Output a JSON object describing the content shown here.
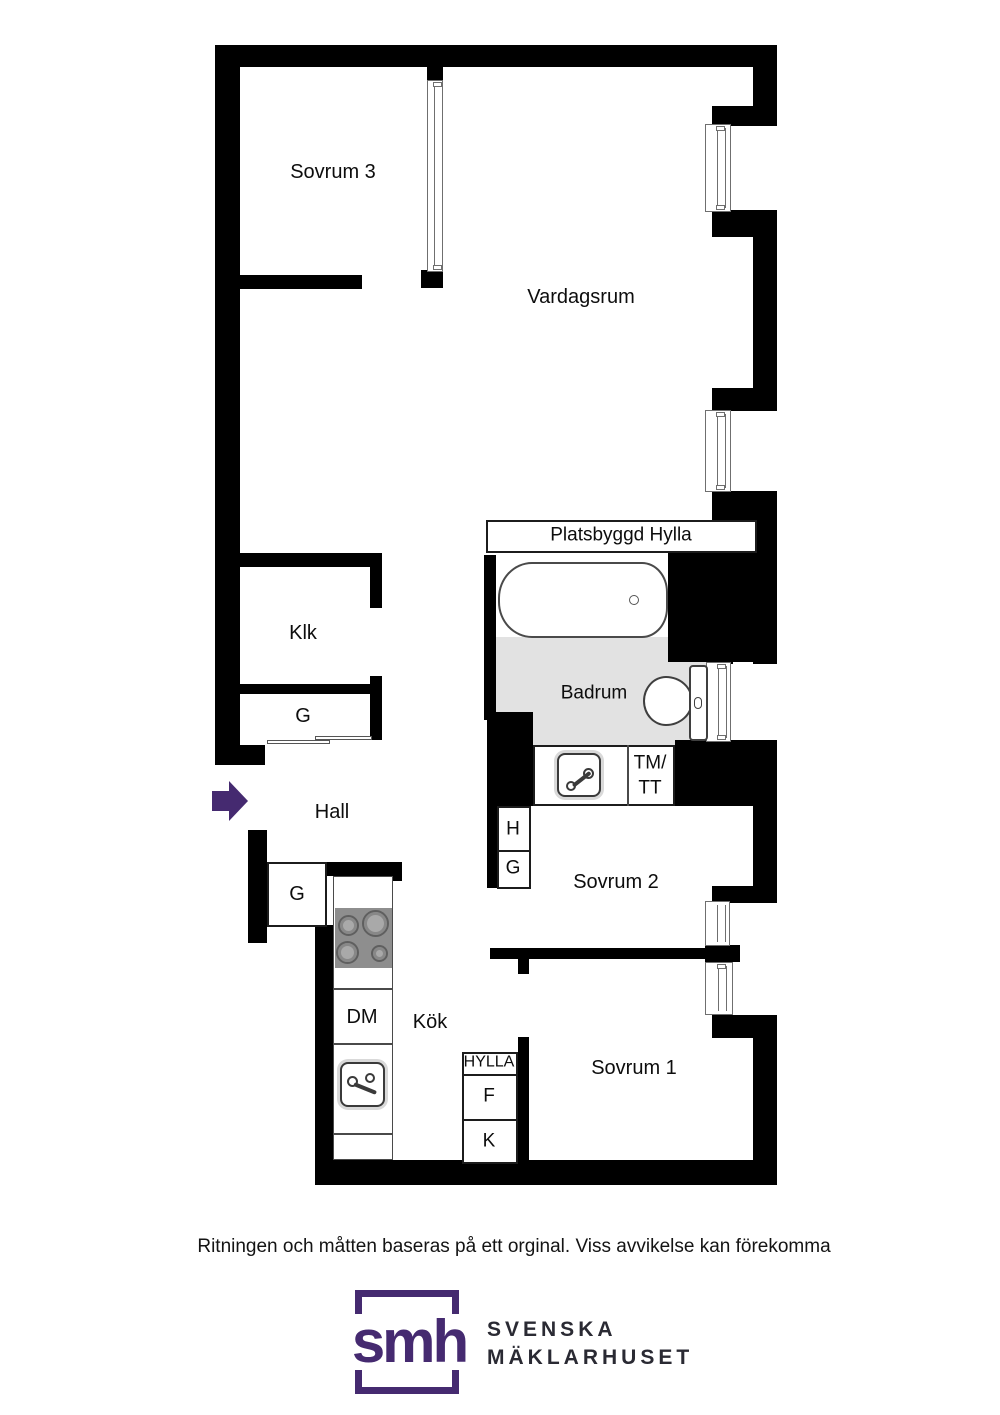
{
  "plan": {
    "labels": {
      "sovrum3": "Sovrum 3",
      "vardagsrum": "Vardagsrum",
      "platsbyggd_hylla": "Platsbyggd Hylla",
      "klk": "Klk",
      "g_closet_klk": "G",
      "badrum": "Badrum",
      "tm_tt": "TM/\nTT",
      "hall": "Hall",
      "h_closet": "H",
      "g_closet_sovrum2": "G",
      "sovrum2": "Sovrum 2",
      "g_closet_hall": "G",
      "dm": "DM",
      "kok": "Kök",
      "hylla": "HYLLA",
      "f": "F",
      "k": "K",
      "sovrum1": "Sovrum 1"
    }
  },
  "footer": {
    "disclaimer": "Ritningen och måtten baseras på ett orginal. Viss avvikelse kan förekomma"
  },
  "logo": {
    "monogram": "smh",
    "name_line1": "SVENSKA",
    "name_line2": "MÄKLARHUSET"
  },
  "colors": {
    "wall": "#000000",
    "bath_floor": "#e2e2e2",
    "brand_purple": "#452a70",
    "stove": "#8e8e8e"
  }
}
